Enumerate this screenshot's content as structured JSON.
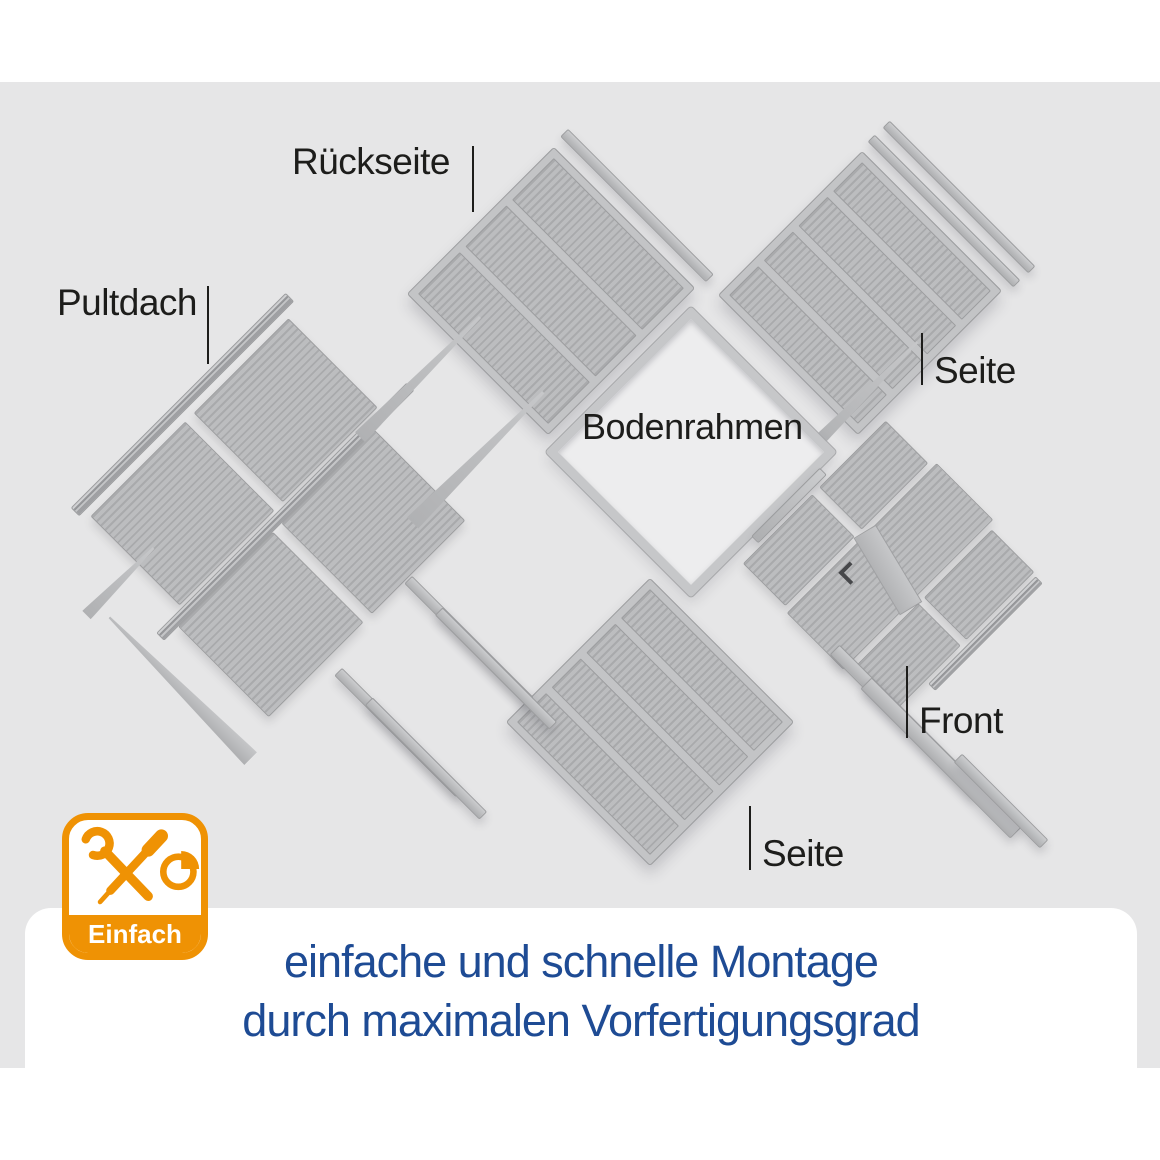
{
  "scene": {
    "labels": {
      "pultdach": "Pultdach",
      "rueckseite": "Rückseite",
      "seite_top": "Seite",
      "bodenrahmen": "Bodenrahmen",
      "front": "Front",
      "seite_bottom": "Seite"
    }
  },
  "badge": {
    "text": "Einfach",
    "icon": "tools-and-clock-icon"
  },
  "caption": {
    "line1": "einfache und schnelle Montage",
    "line2": "durch maximalen Vorfertigungsgrad"
  },
  "colors": {
    "accent_orange": "#EF9204",
    "caption_blue": "#1E4B94",
    "label_dark": "#1D1D1B",
    "background_gray": "#E6E6E7",
    "panel_gray": "#B9BABC"
  }
}
